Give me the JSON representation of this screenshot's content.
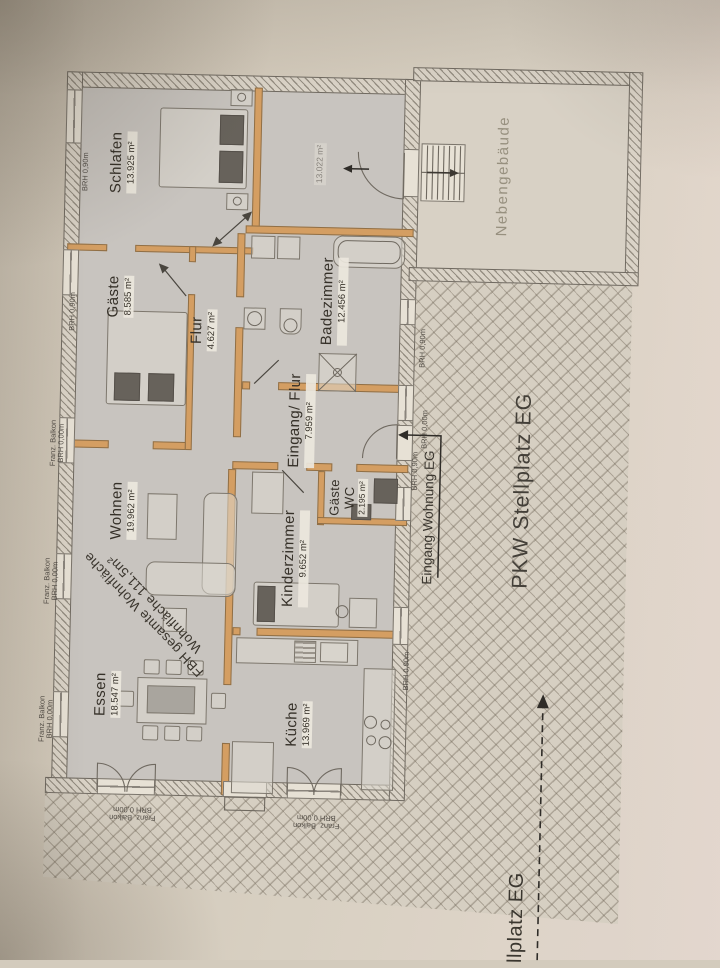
{
  "rooms": [
    {
      "name": "Schlafen",
      "area": "13.925 m²"
    },
    {
      "name": "Gäste",
      "area": "8.585 m²"
    },
    {
      "name": "Flur",
      "area": "4.627 m²"
    },
    {
      "name": "Badezimmer",
      "area": "12.456 m²"
    },
    {
      "name": "Eingang/ Flur",
      "area": "7.959 m²"
    },
    {
      "name": "Gäste",
      "line2": "WC",
      "area": "2.195 m²"
    },
    {
      "name": "Kinderzimmer",
      "area": "9.652 m²"
    },
    {
      "name": "Wohnen",
      "area": "19.962 m²"
    },
    {
      "name": "Essen",
      "area": "18.547 m²"
    },
    {
      "name": "Küche",
      "area": "13.969 m²"
    }
  ],
  "outdoor": {
    "pkw": "PKW Stellplatz EG",
    "stellplatz_cut": "llplatz EG",
    "eingang": "Eingang Wohnung EG",
    "nebengebaeude": "Nebengebäude",
    "faint_area": "13.022 m²"
  },
  "summary": {
    "line1": "FBH gesamte Wohnfläche",
    "line2": "Wohnfläche 111,5m²"
  },
  "edge_labels": {
    "left": [
      {
        "l1": "BRH 0,90m"
      },
      {
        "l1": "BRH 0,90m"
      },
      {
        "l1": "Franz. Balkon",
        "l2": "BRH 0,00m"
      },
      {
        "l1": "Franz. Balkon",
        "l2": "BRH 0,00m"
      },
      {
        "l1": "Franz. Balkon",
        "l2": "BRH 0,00m"
      }
    ],
    "right": [
      {
        "l1": "BRH 0,90m"
      },
      {
        "l1": "BRH 0,00m"
      },
      {
        "l1": "BRH 0,90m"
      },
      {
        "l1": "BRH 0,90m"
      }
    ],
    "bottom": [
      {
        "l1": "Franz. Balkon",
        "l2": "BRH 0,00m"
      },
      {
        "l1": "Franz. Balkon",
        "l2": "BRH 0,00m"
      }
    ]
  },
  "colors": {
    "new_wall_accent": "#d49e62",
    "existing_wall_hatch": "#dad3c7",
    "room_fill": "#c8c4bf",
    "paper": "#d8d1c5",
    "line": "#6f6960",
    "text": "#353028"
  }
}
